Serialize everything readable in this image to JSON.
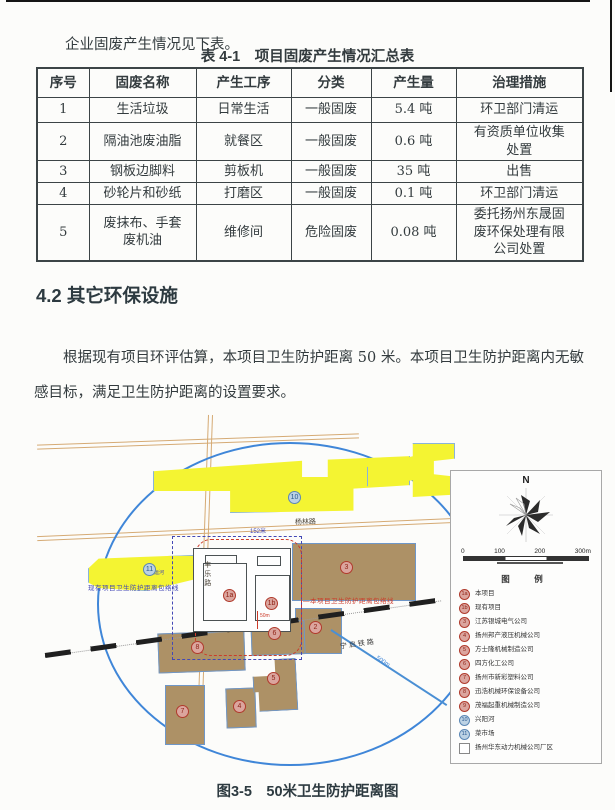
{
  "intro": {
    "text": "企业固废产生情况见下表。"
  },
  "table": {
    "title": "表 4-1　项目固废产生情况汇总表",
    "headers": [
      "序号",
      "固废名称",
      "产生工序",
      "分类",
      "产生量",
      "治理措施"
    ],
    "rows": [
      [
        "1",
        "生活垃圾",
        "日常生活",
        "一般固废",
        "5.4 吨",
        "环卫部门清运"
      ],
      [
        "2",
        "隔油池废油脂",
        "就餐区",
        "一般固废",
        "0.6 吨",
        "有资质单位收集\n处置"
      ],
      [
        "3",
        "钢板边脚料",
        "剪板机",
        "一般固废",
        "35 吨",
        "出售"
      ],
      [
        "4",
        "砂轮片和砂纸",
        "打磨区",
        "一般固废",
        "0.1 吨",
        "环卫部门清运"
      ],
      [
        "5",
        "废抹布、手套\n废机油",
        "维修间",
        "危险固废",
        "0.08 吨",
        "委托扬州东晟固\n废环保处理有限\n公司处置"
      ]
    ]
  },
  "section": {
    "heading": "4.2 其它环保设施",
    "paragraph": "根据现有项目环评估算，本项目卫生防护距离 50 米。本项目卫生防护距离内无敏感目标，满足卫生防护距离的设置要求。"
  },
  "figure": {
    "caption": "图3-5　50米卫生防护距离图",
    "compass": {
      "north_label": "N"
    },
    "scalebar": {
      "ticks": [
        "0",
        "100",
        "200",
        "300m"
      ]
    },
    "legend": {
      "title": "图　例",
      "items": [
        {
          "marker": "1a",
          "type": "red",
          "label": "本项目"
        },
        {
          "marker": "1b",
          "type": "red",
          "label": "现有项目"
        },
        {
          "marker": "3",
          "type": "red",
          "label": "江苏银城电气公司"
        },
        {
          "marker": "4",
          "type": "red",
          "label": "扬州邦产液压机械公司"
        },
        {
          "marker": "5",
          "type": "red",
          "label": "方士隆机械制造公司"
        },
        {
          "marker": "6",
          "type": "red",
          "label": "四方化工公司"
        },
        {
          "marker": "7",
          "type": "red",
          "label": "扬州市新彩塑料公司"
        },
        {
          "marker": "8",
          "type": "red",
          "label": "迅浩机械环保设备公司"
        },
        {
          "marker": "9",
          "type": "red",
          "label": "茂福起重机械制造公司"
        },
        {
          "marker": "10",
          "type": "blue",
          "label": "兴阳河"
        },
        {
          "marker": "11",
          "type": "blue",
          "label": "菜市场"
        },
        {
          "marker": "",
          "type": "square",
          "label": "扬州华东动力机械公司厂区"
        }
      ]
    },
    "map_labels": {
      "road_yanglin": "杨林路",
      "road_fengle": "丰乐路",
      "railway": "宁启铁路",
      "dist_152": "152米",
      "dist_50": "50m",
      "dist_500": "500m",
      "existing_envelope": "现有项目卫生防护距离包络线",
      "project_envelope": "—本项目卫生防护距离包络线",
      "canal": "古运河"
    },
    "markers": [
      "1a",
      "1b",
      "3",
      "2",
      "8",
      "6",
      "7",
      "4",
      "5",
      "10",
      "11"
    ]
  }
}
